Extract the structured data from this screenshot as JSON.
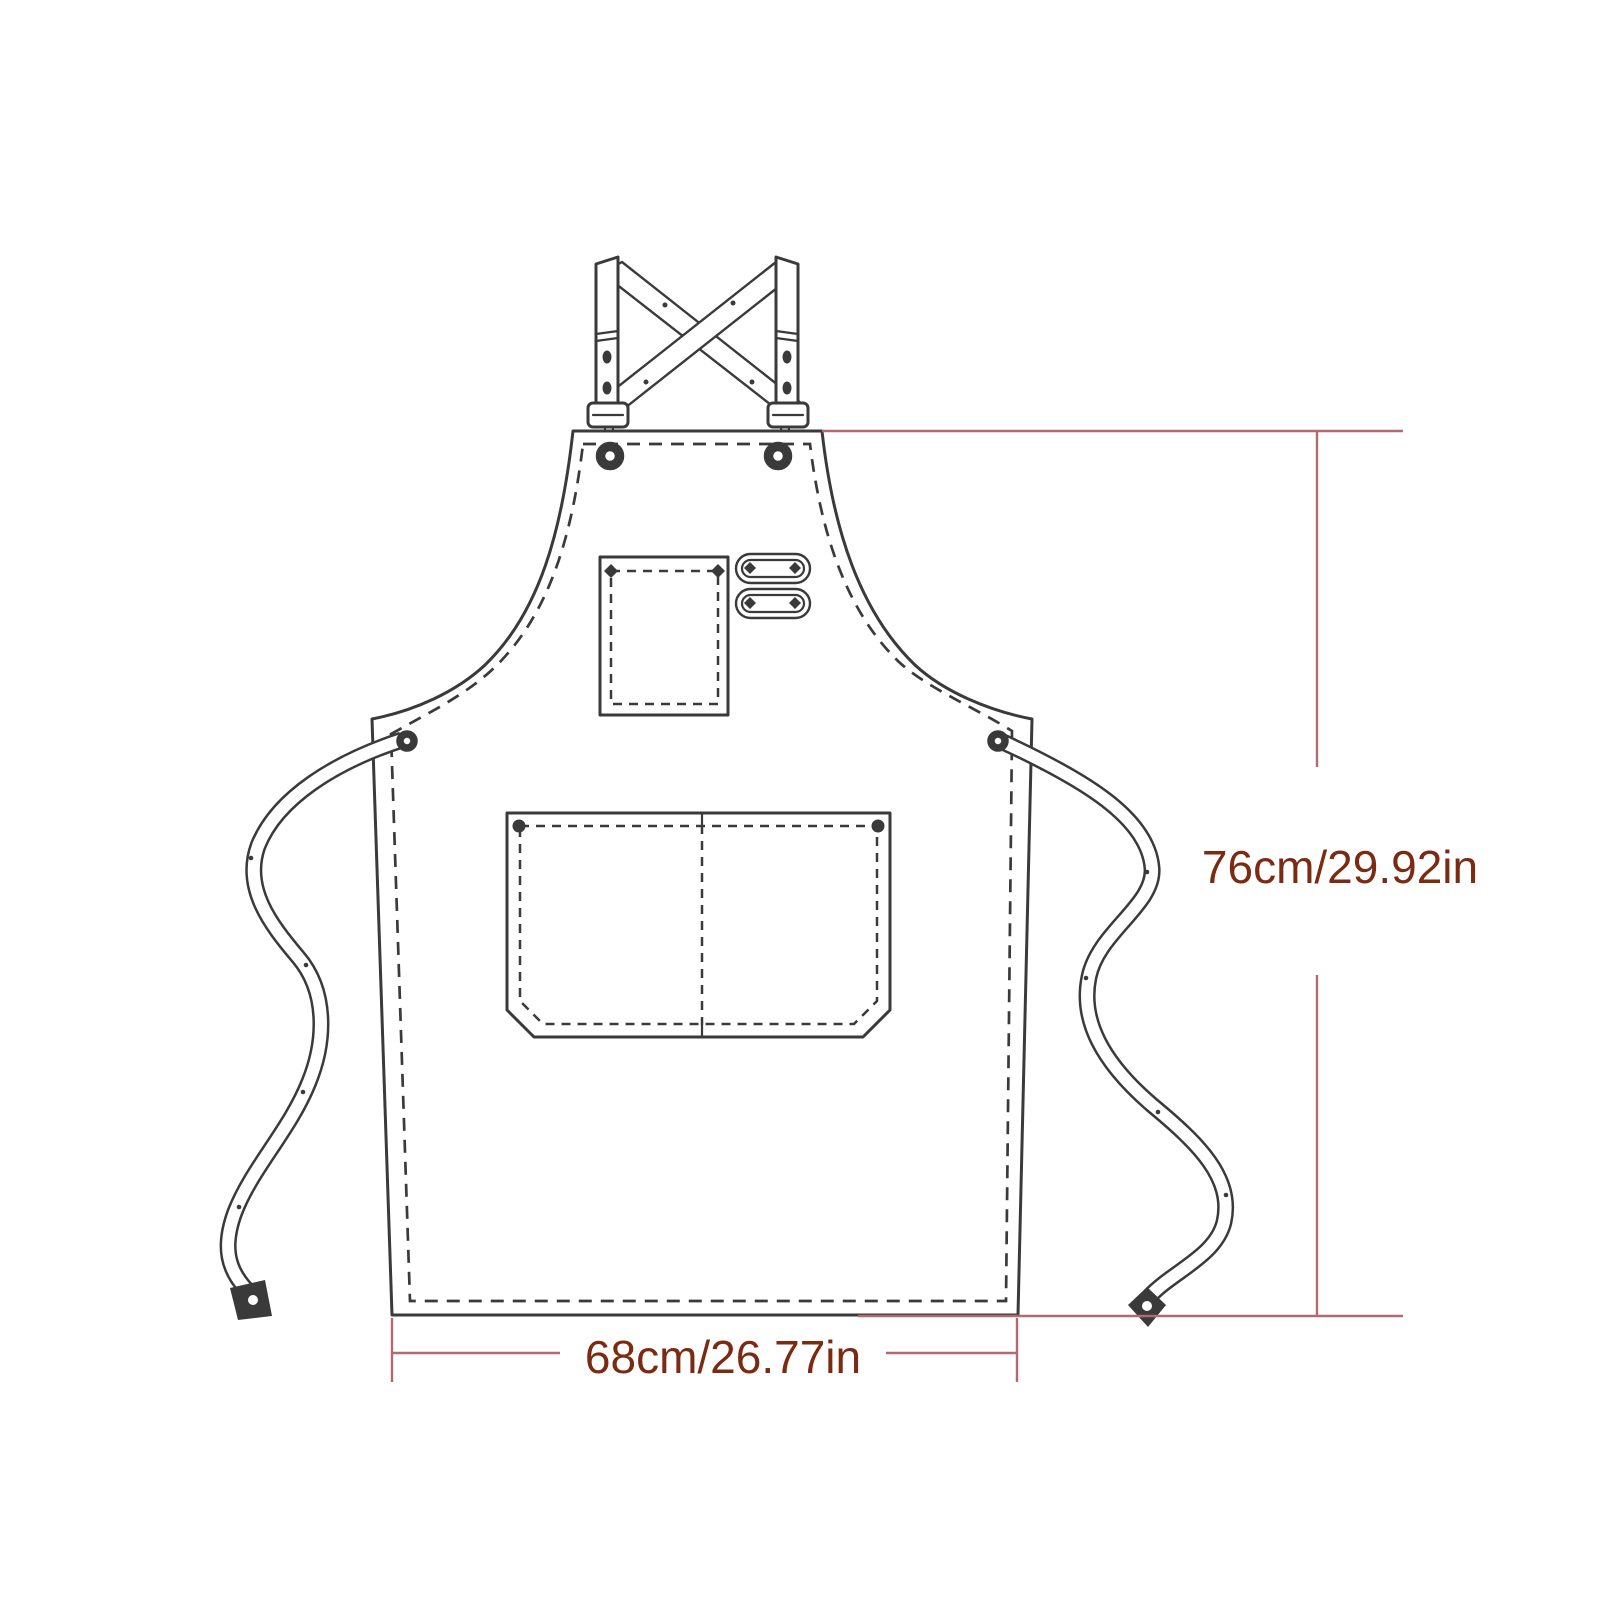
{
  "diagram": {
    "labels": {
      "height": "76cm/29.92in",
      "width": "68cm/26.77in"
    },
    "colors": {
      "line_art": "#3a3a3a",
      "dimension_line": "#b36972",
      "dimension_text": "#7a2b11",
      "background": "#ffffff"
    }
  }
}
